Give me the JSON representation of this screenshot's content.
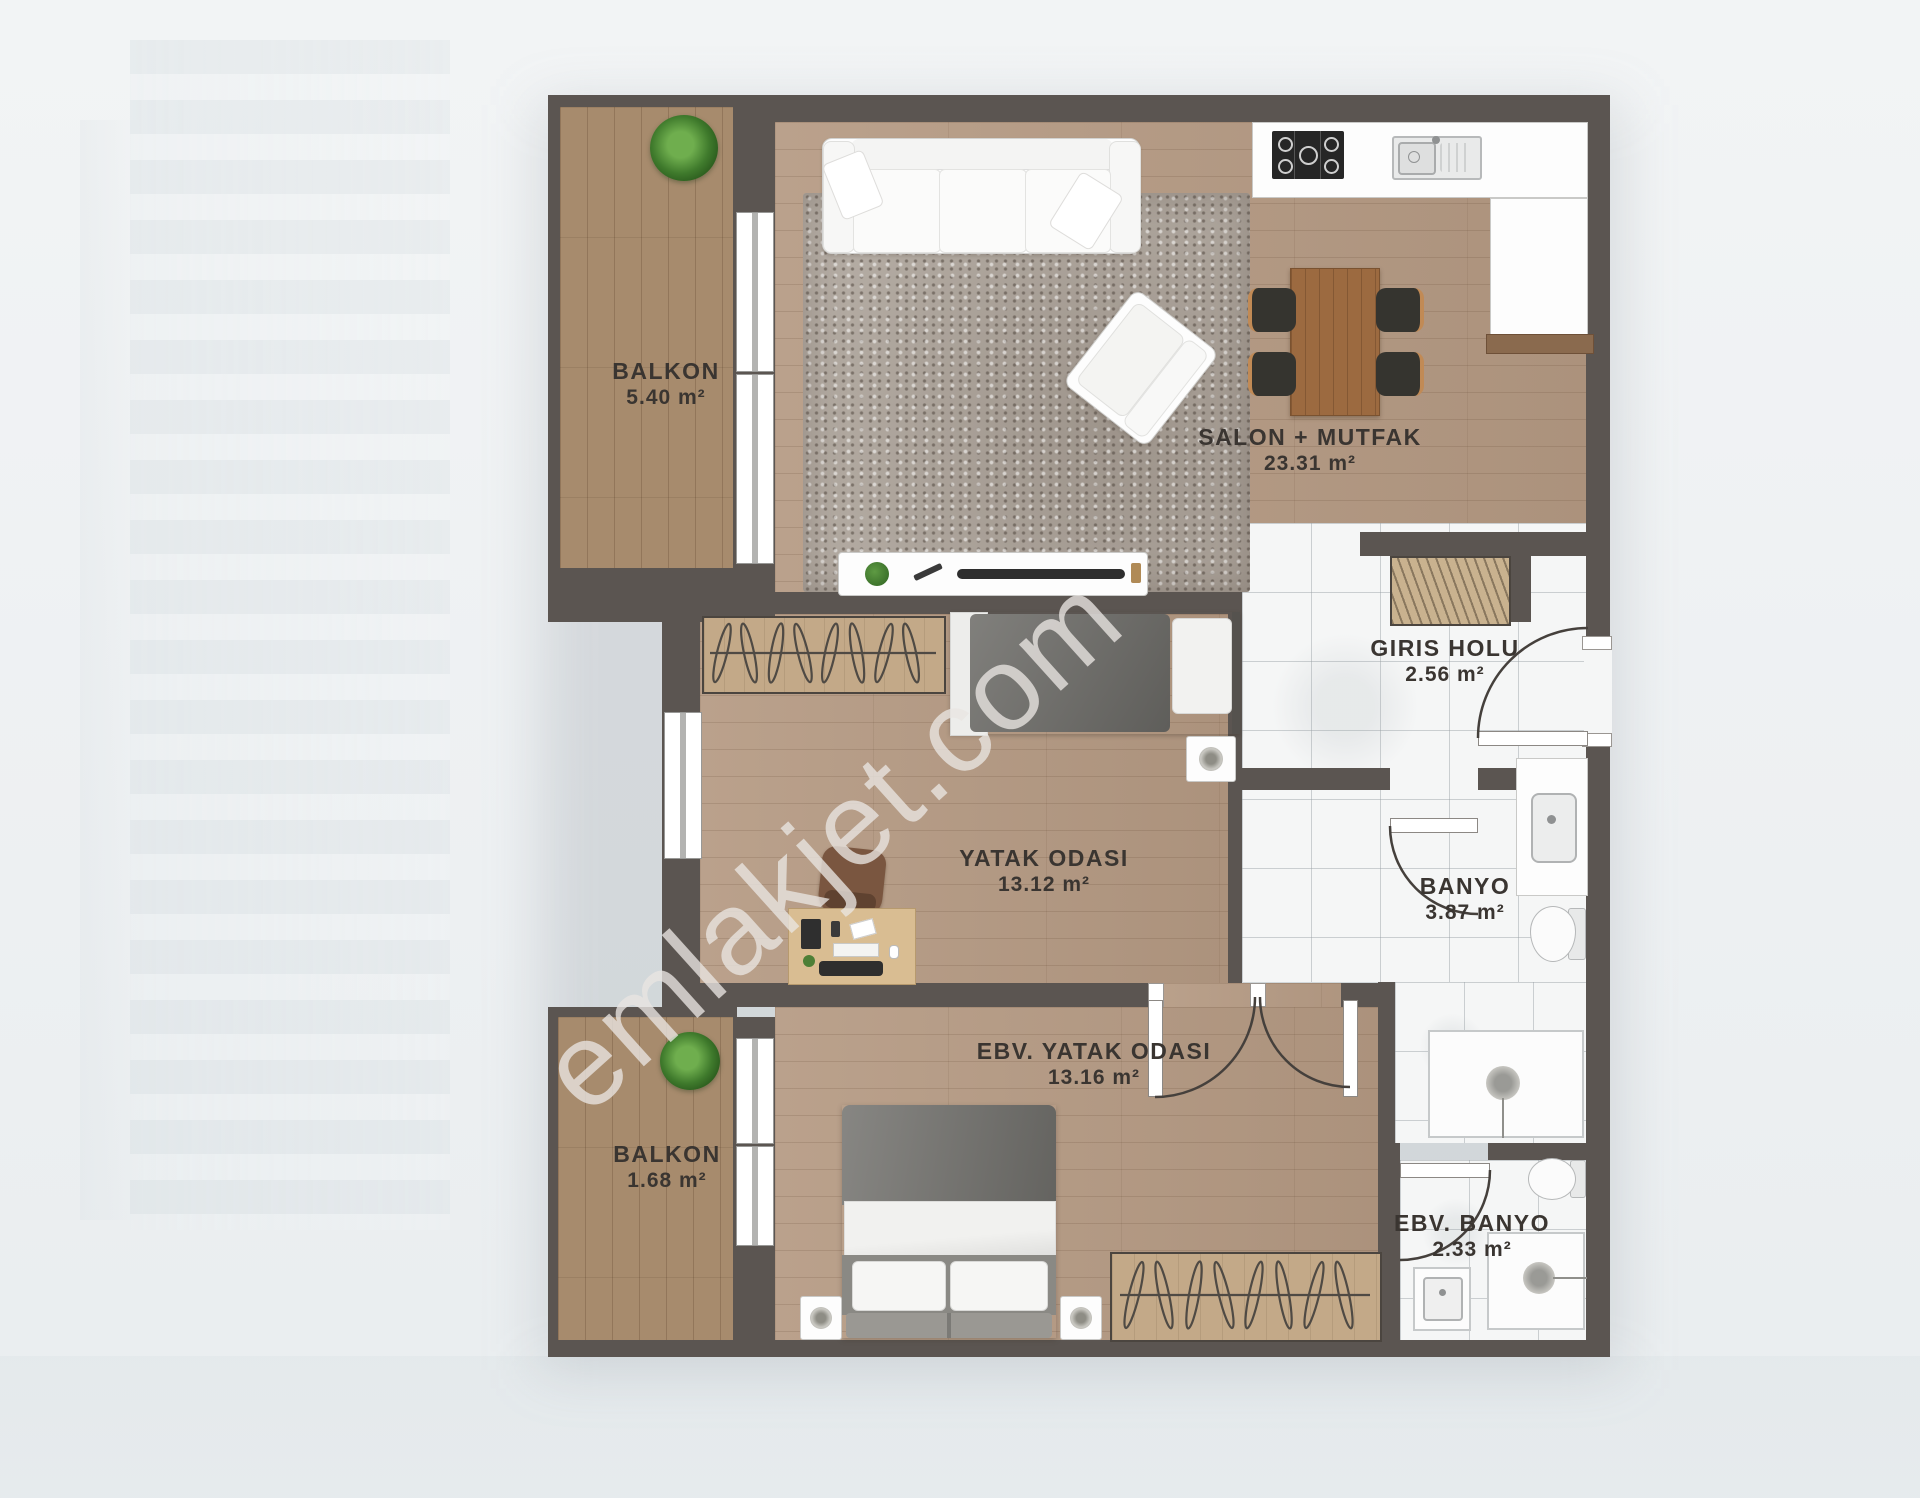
{
  "watermark": "emlakjet.com",
  "rooms": [
    {
      "id": "balkon1",
      "name": "BALKON",
      "area": "5.40 m²"
    },
    {
      "id": "salon",
      "name": "SALON + MUTFAK",
      "area": "23.31 m²"
    },
    {
      "id": "giris",
      "name": "GIRIS HOLU",
      "area": "2.56 m²"
    },
    {
      "id": "yatak",
      "name": "YATAK ODASI",
      "area": "13.12 m²"
    },
    {
      "id": "banyo",
      "name": "BANYO",
      "area": "3.87 m²"
    },
    {
      "id": "ebv_yatak",
      "name": "EBV. YATAK ODASI",
      "area": "13.16 m²"
    },
    {
      "id": "balkon2",
      "name": "BALKON",
      "area": "1.68 m²"
    },
    {
      "id": "ebv_banyo",
      "name": "EBV. BANYO",
      "area": "2.33 m²"
    }
  ],
  "colors": {
    "wall": "#5b5551",
    "wood": "#b59a83",
    "deck": "#a78b6d",
    "marble": "#f5f6f6",
    "accent_table": "#9c6a40"
  }
}
